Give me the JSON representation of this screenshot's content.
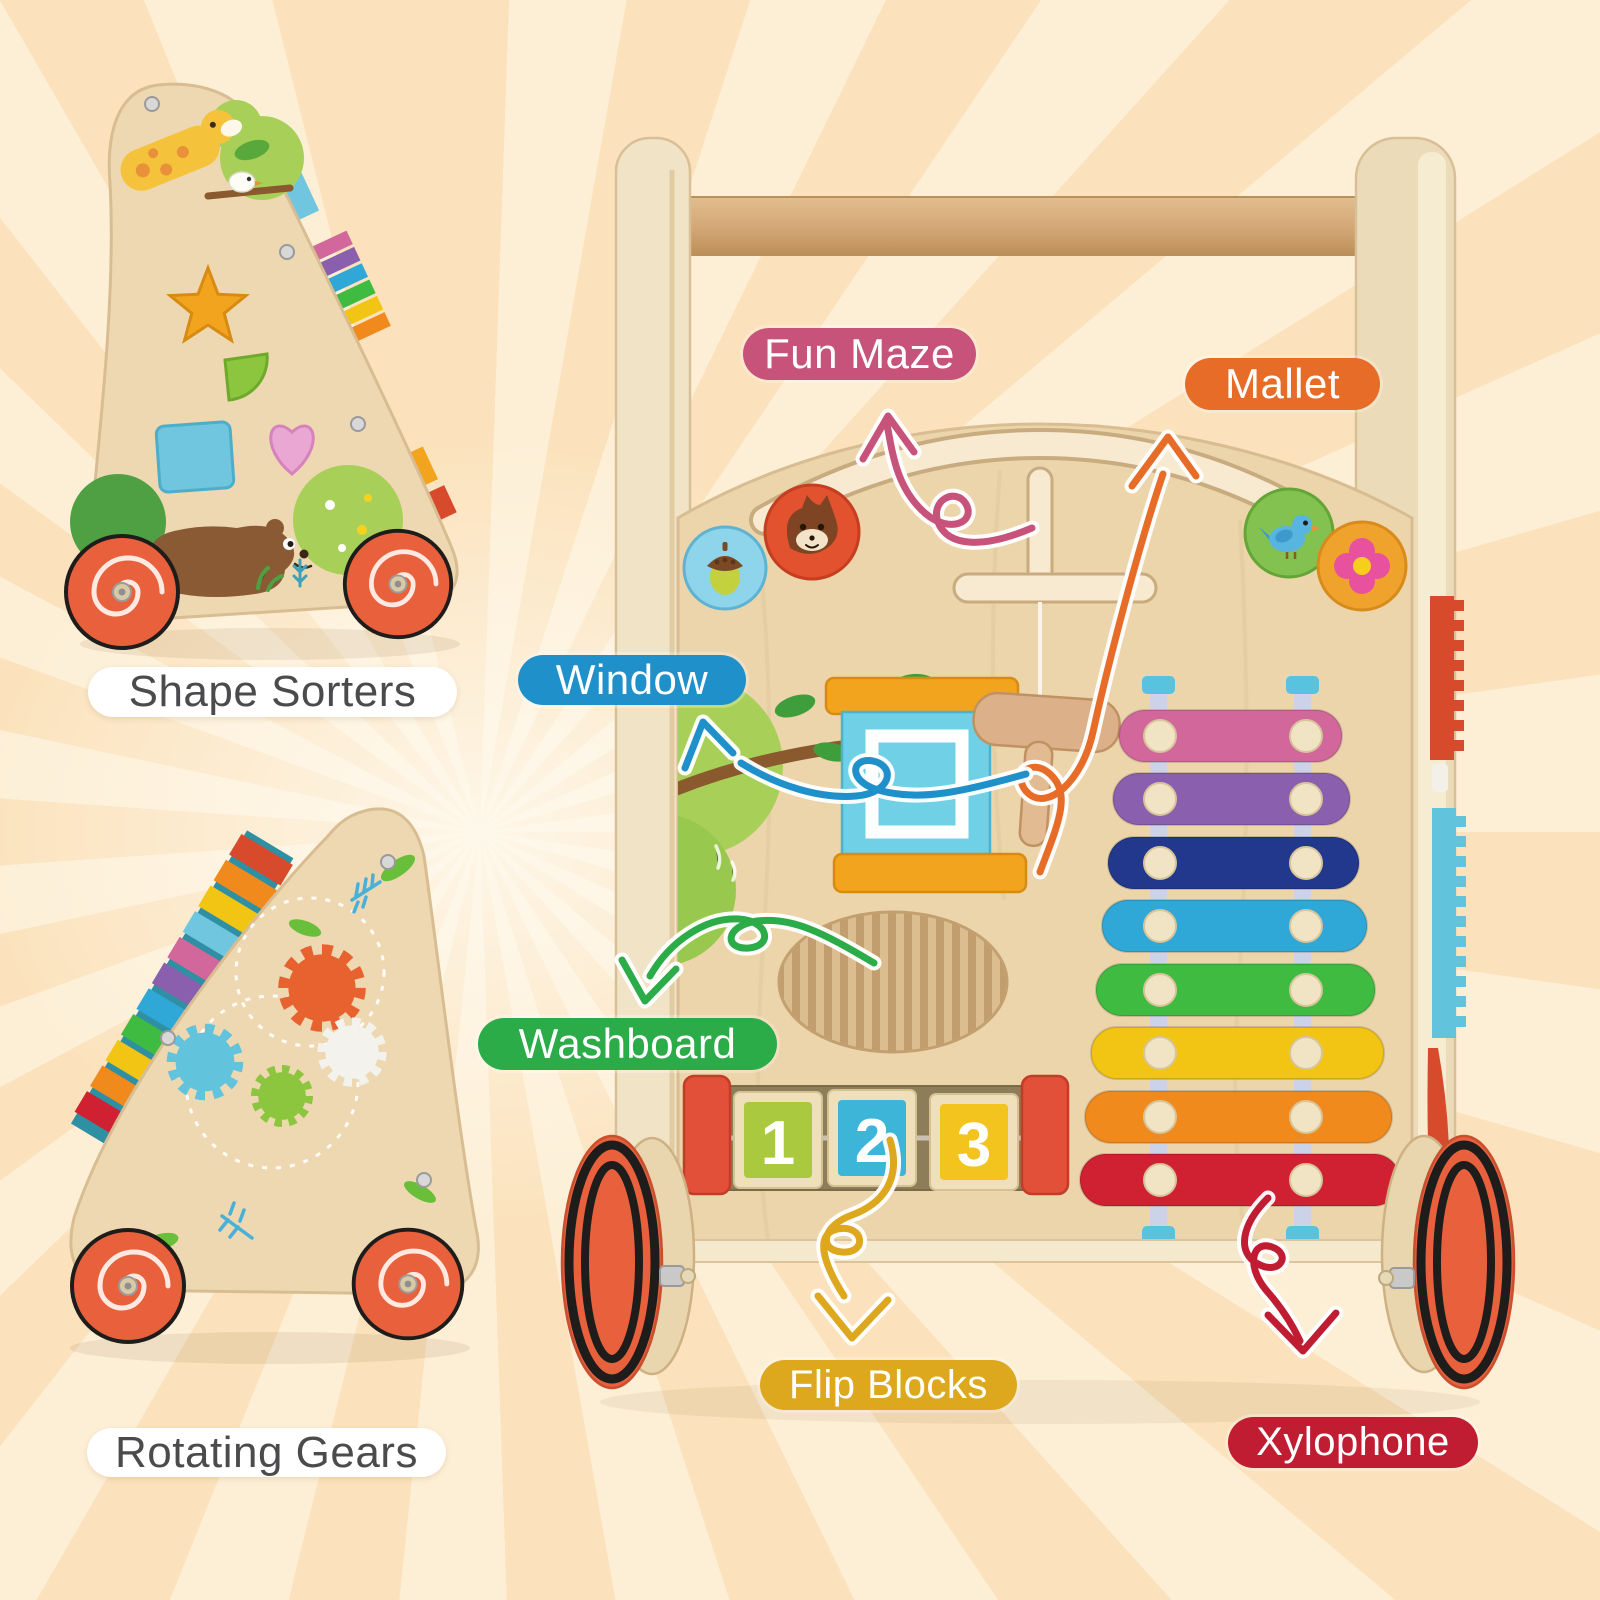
{
  "background": {
    "base_color": "#fbe2bc",
    "ray_color": "#fdefd6"
  },
  "callouts": {
    "fun_maze": {
      "label": "Fun Maze",
      "color": "#c7537b"
    },
    "mallet": {
      "label": "Mallet",
      "color": "#e66c27"
    },
    "window": {
      "label": "Window",
      "color": "#2090cb"
    },
    "washboard": {
      "label": "Washboard",
      "color": "#2cab49"
    },
    "flip_blocks": {
      "label": "Flip Blocks",
      "color": "#dda81e"
    },
    "xylophone": {
      "label": "Xylophone",
      "color": "#c01d32"
    }
  },
  "side_view_labels": {
    "shape_sorters": {
      "label": "Shape Sorters",
      "pill_color": "#ffffff",
      "text_color": "#4b4b4d"
    },
    "rotating_gears": {
      "label": "Rotating Gears",
      "pill_color": "#ffffff",
      "text_color": "#4b4b4d"
    }
  },
  "walker": {
    "wood_color": "#ecd4ab",
    "handle_color": "#d2a774",
    "wheel_color": "#e8613c",
    "maze_discs": [
      {
        "name": "acorn-disc",
        "color": "#8ed4ea"
      },
      {
        "name": "squirrel-disc",
        "color": "#e2522e"
      },
      {
        "name": "bird-disc",
        "color": "#83c250"
      },
      {
        "name": "flower-disc",
        "color": "#f0a32c"
      }
    ],
    "window": {
      "frame_color": "#f2a41e",
      "pane_color": "#6fd0e6"
    },
    "flip_blocks": {
      "digits": [
        "1",
        "2",
        "3"
      ],
      "face_colors": [
        "#abc93e",
        "#3db5d9",
        "#f2c41d"
      ],
      "post_color": "#e2503a"
    },
    "xylophone": {
      "bar_colors": [
        "#d2679c",
        "#8a5fae",
        "#21388c",
        "#2fa8d8",
        "#3fbb41",
        "#f2c413",
        "#f08a1d",
        "#d02132"
      ],
      "peg_color": "#f0e4c4"
    }
  },
  "gears": {
    "colors": [
      "#e8622f",
      "#62c3dd",
      "#8cc63f",
      "#f4f2ec"
    ]
  }
}
